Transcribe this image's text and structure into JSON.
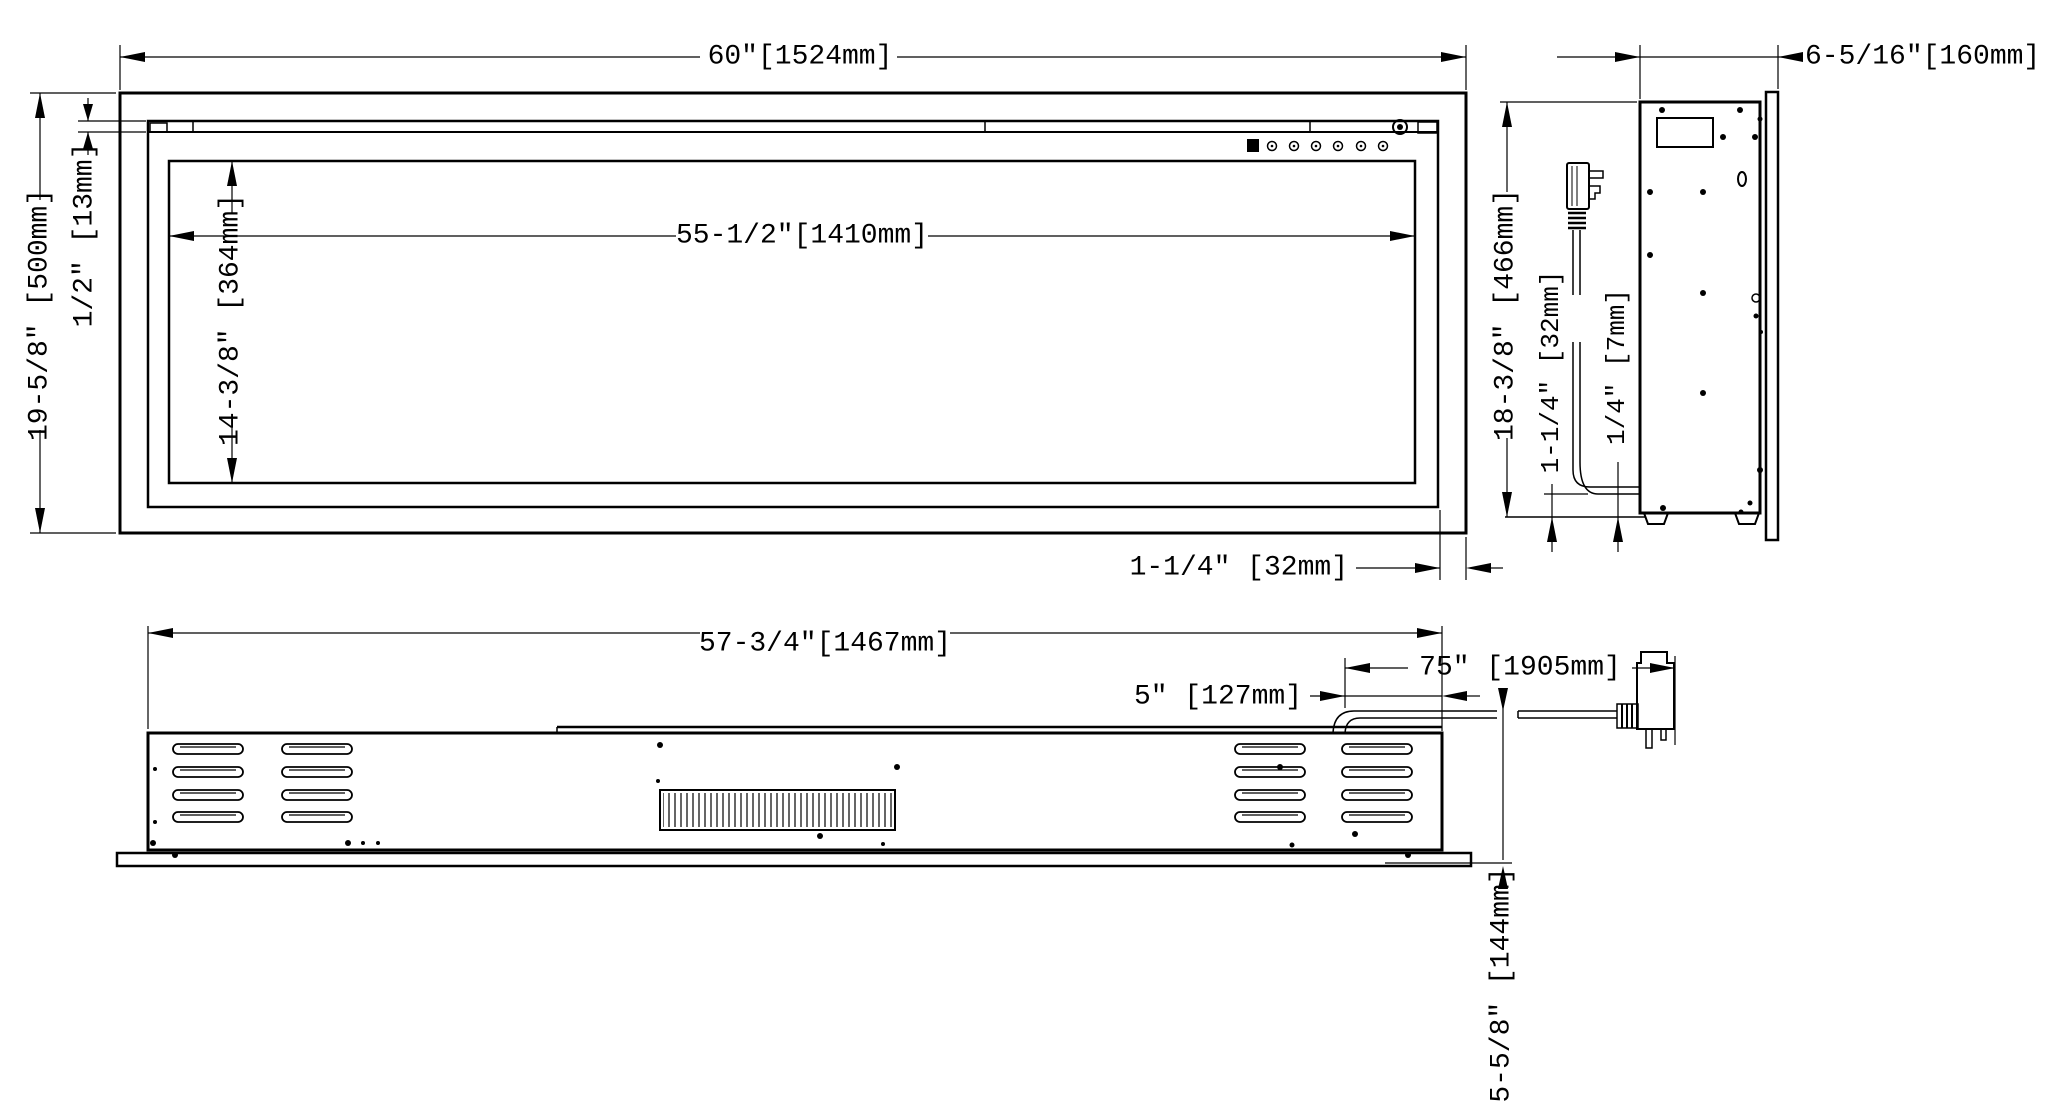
{
  "drawing": {
    "front": {
      "width": "60″[1524mm]",
      "inner_width": "55-1/2″[1410mm]",
      "height": "19-5/8″ [500mm]",
      "glass_ledge": "1/2″ [13mm]",
      "opening_height": "14-3/8″ [364mm]",
      "frame_overhang": "1-1/4″ [32mm]"
    },
    "side": {
      "depth": "6-5/16″[160mm]",
      "height": "18-3/8″ [466mm]",
      "cord_offset": "1-1/4″ [32mm]",
      "cord_clearance": "1/4″ [7mm]"
    },
    "rear": {
      "width": "57-3/4″[1467mm]",
      "cord_inset": "5″ [127mm]",
      "cord_length": "75″ [1905mm]",
      "cord_drop": "5-5/8″ [144mm]"
    },
    "colors": {
      "line": "#000000",
      "background": "#ffffff"
    }
  }
}
